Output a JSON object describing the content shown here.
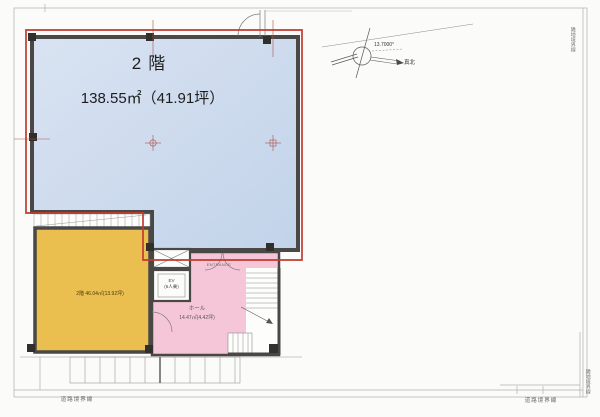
{
  "rooms": {
    "main": {
      "floor": "2階",
      "area": "138.55㎡（41.91坪）"
    },
    "second": {
      "label": "2階 46.04㎡(13.92坪)"
    },
    "hall": {
      "name": "ホール",
      "area": "14.47㎡(4.42坪)"
    },
    "elevator": {
      "name": "EV",
      "capacity": "(6人乗)"
    },
    "entrance": {
      "label": "ENTRANCE"
    }
  },
  "compass": {
    "angle": "13.7000°",
    "true_north": "真北"
  },
  "boundaries": {
    "bottom_left": "道路境界線",
    "bottom_right": "道路境界線",
    "right_top": "隣地境界線",
    "right_bottom": "隣地境界線"
  },
  "colors": {
    "leased_outline": "#c23b30",
    "main_room_fill": "#c9d8ec",
    "second_room_fill": "#eabf4f",
    "hall_fill": "#f5c6d8",
    "wall": "#4a4846"
  }
}
